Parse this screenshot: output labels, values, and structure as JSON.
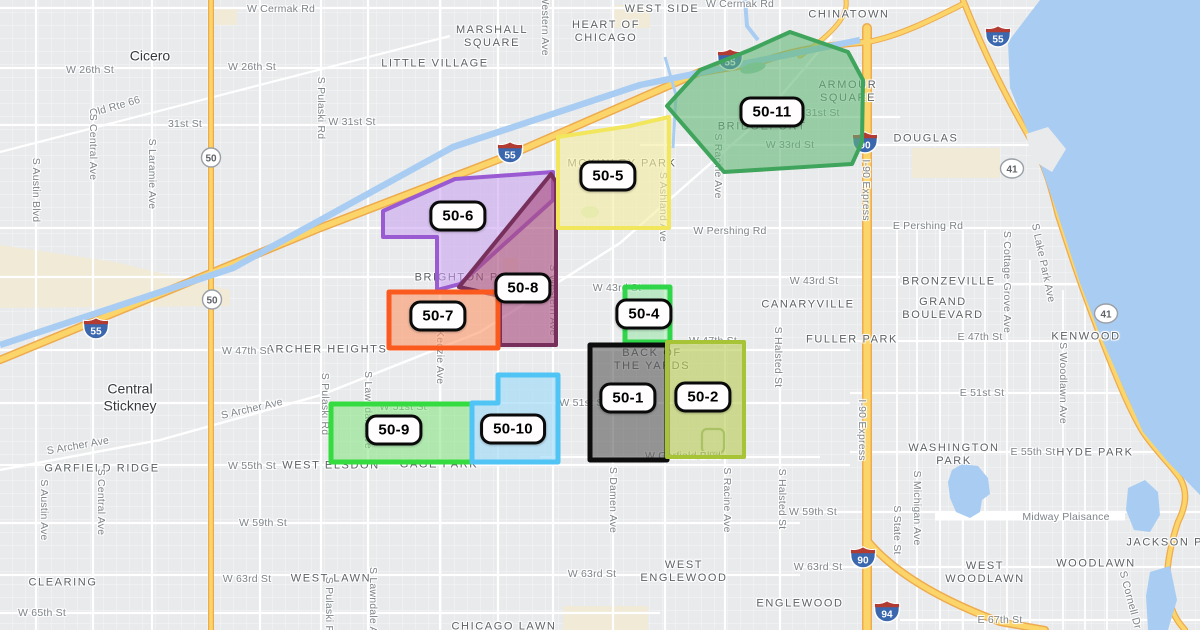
{
  "map": {
    "attribution": "",
    "colors": {
      "land": "#e9eaec",
      "water": "#a9cdf2",
      "road": "#ffffff",
      "highway_fill": "#fbd56a",
      "highway_casing": "#eeab4e",
      "park_beige": "#f0ead7",
      "hood_text": "#5d6266",
      "street_text": "#7e8489",
      "zone_label_bg": "#fffdfd",
      "zone_label_border": "#0a0a0a"
    },
    "zones": [
      {
        "id": "zone-50-6",
        "label": "50-6",
        "stroke": "#9a5bd2",
        "fill": "#c79df0",
        "fill_opacity": 0.55,
        "stroke_width": 4,
        "points": "383,211 455,179 553,172 553,200 460,284 437,290 437,237 383,237",
        "label_x": 458,
        "label_y": 216
      },
      {
        "id": "zone-50-8",
        "label": "50-8",
        "stroke": "#77305c",
        "fill": "#aa4e7e",
        "fill_opacity": 0.62,
        "stroke_width": 4,
        "points": "551,174 556,182 556,345 500,345 500,296 459,287",
        "label_x": 523,
        "label_y": 288
      },
      {
        "id": "zone-50-5",
        "label": "50-5",
        "stroke": "#f2e65c",
        "fill": "#f6eea0",
        "fill_opacity": 0.62,
        "stroke_width": 4,
        "points": "558,137 630,126 669,117 669,228 558,228",
        "label_x": 608,
        "label_y": 176
      },
      {
        "id": "zone-50-11",
        "label": "50-11",
        "stroke": "#3fa45c",
        "fill": "#63b877",
        "fill_opacity": 0.6,
        "stroke_width": 4,
        "points": "790,32 848,52 863,80 862,142 852,164 724,172 667,106 700,70 750,50",
        "label_x": 772,
        "label_y": 112
      },
      {
        "id": "zone-50-7",
        "label": "50-7",
        "stroke": "#fa5a1e",
        "fill": "#fb9a6c",
        "fill_opacity": 0.62,
        "stroke_width": 5,
        "points": "389,292 498,292 498,348 389,348",
        "label_x": 438,
        "label_y": 316
      },
      {
        "id": "zone-50-4",
        "label": "50-4",
        "stroke": "#2fd64a",
        "fill": "#8fe59f",
        "fill_opacity": 0.5,
        "stroke_width": 5,
        "points": "625,287 670,287 670,342 625,342",
        "label_x": 644,
        "label_y": 314
      },
      {
        "id": "zone-50-1",
        "label": "50-1",
        "stroke": "#0d0d0d",
        "fill": "#555555",
        "fill_opacity": 0.58,
        "stroke_width": 5,
        "points": "590,345 667,345 667,460 590,460",
        "label_x": 628,
        "label_y": 398
      },
      {
        "id": "zone-50-2",
        "label": "50-2",
        "stroke": "#a6c435",
        "fill": "#b9cc55",
        "fill_opacity": 0.62,
        "stroke_width": 4,
        "points": "667,342 744,342 744,457 667,457",
        "label_x": 703,
        "label_y": 397
      },
      {
        "id": "zone-50-9",
        "label": "50-9",
        "stroke": "#35dc3f",
        "fill": "#7fe47c",
        "fill_opacity": 0.55,
        "stroke_width": 5,
        "points": "331,404 472,404 472,462 331,462",
        "label_x": 394,
        "label_y": 430
      },
      {
        "id": "zone-50-10",
        "label": "50-10",
        "stroke": "#4fc4f5",
        "fill": "#a5dcf8",
        "fill_opacity": 0.7,
        "stroke_width": 5,
        "points": "498,375 558,375 558,462 472,462 472,403 498,403",
        "label_x": 513,
        "label_y": 429
      }
    ],
    "neighborhoods": [
      {
        "text": "Cicero",
        "x": 150,
        "y": 56,
        "style": "town"
      },
      {
        "text": "Central\nStickney",
        "x": 130,
        "y": 397,
        "style": "town"
      },
      {
        "text": "MARSHALL\nSQUARE",
        "x": 492,
        "y": 37,
        "style": "hood"
      },
      {
        "text": "LITTLE VILLAGE",
        "x": 435,
        "y": 64,
        "style": "hood"
      },
      {
        "text": "HEART OF\nCHICAGO",
        "x": 606,
        "y": 32,
        "style": "hood"
      },
      {
        "text": "LOWER\nWEST SIDE",
        "x": 662,
        "y": 3,
        "style": "hood"
      },
      {
        "text": "CHINATOWN",
        "x": 849,
        "y": 15,
        "style": "hood"
      },
      {
        "text": "ARMOUR\nSQUARE",
        "x": 848,
        "y": 92,
        "style": "hood"
      },
      {
        "text": "DOUGLAS",
        "x": 926,
        "y": 139,
        "style": "hood"
      },
      {
        "text": "BRIDGEPORT",
        "x": 762,
        "y": 127,
        "style": "hood"
      },
      {
        "text": "MCKINLEY PARK",
        "x": 622,
        "y": 164,
        "style": "hood"
      },
      {
        "text": "BRIGHTON PARK",
        "x": 470,
        "y": 278,
        "style": "hood"
      },
      {
        "text": "ARCHER HEIGHTS",
        "x": 327,
        "y": 350,
        "style": "hood"
      },
      {
        "text": "BACK OF\nTHE YARDS",
        "x": 652,
        "y": 360,
        "style": "hood"
      },
      {
        "text": "CANARYVILLE",
        "x": 808,
        "y": 305,
        "style": "hood"
      },
      {
        "text": "FULLER PARK",
        "x": 852,
        "y": 340,
        "style": "hood"
      },
      {
        "text": "BRONZEVILLE",
        "x": 949,
        "y": 282,
        "style": "hood"
      },
      {
        "text": "GRAND\nBOULEVARD",
        "x": 943,
        "y": 309,
        "style": "hood"
      },
      {
        "text": "KENWOOD",
        "x": 1086,
        "y": 337,
        "style": "hood"
      },
      {
        "text": "WASHINGTON\nPARK",
        "x": 954,
        "y": 455,
        "style": "hood"
      },
      {
        "text": "HYDE PARK",
        "x": 1095,
        "y": 453,
        "style": "hood"
      },
      {
        "text": "WEST ELSDON",
        "x": 331,
        "y": 466,
        "style": "hood"
      },
      {
        "text": "GAGE PARK",
        "x": 439,
        "y": 465,
        "style": "hood"
      },
      {
        "text": "GARFIELD RIDGE",
        "x": 102,
        "y": 469,
        "style": "hood"
      },
      {
        "text": "CLEARING",
        "x": 63,
        "y": 583,
        "style": "hood"
      },
      {
        "text": "WEST LAWN",
        "x": 331,
        "y": 579,
        "style": "hood"
      },
      {
        "text": "WEST\nENGLEWOOD",
        "x": 684,
        "y": 572,
        "style": "hood"
      },
      {
        "text": "ENGLEWOOD",
        "x": 800,
        "y": 604,
        "style": "hood"
      },
      {
        "text": "CHICAGO LAWN",
        "x": 504,
        "y": 627,
        "style": "hood"
      },
      {
        "text": "WEST\nWOODLAWN",
        "x": 985,
        "y": 573,
        "style": "hood"
      },
      {
        "text": "WOODLAWN",
        "x": 1096,
        "y": 564,
        "style": "hood"
      },
      {
        "text": "JACKSON PARK",
        "x": 1178,
        "y": 543,
        "style": "hood"
      }
    ],
    "streets": [
      {
        "text": "W Cermak Rd",
        "x": 281,
        "y": 9,
        "r": 0
      },
      {
        "text": "W Cermak Rd",
        "x": 740,
        "y": 4,
        "r": 0
      },
      {
        "text": "W 26th St",
        "x": 90,
        "y": 70,
        "r": 0
      },
      {
        "text": "W 26th St",
        "x": 252,
        "y": 67,
        "r": 0
      },
      {
        "text": "Old Rte 66",
        "x": 115,
        "y": 107,
        "r": -16
      },
      {
        "text": "31st St",
        "x": 185,
        "y": 124,
        "r": 0
      },
      {
        "text": "W 31st St",
        "x": 352,
        "y": 122,
        "r": 0
      },
      {
        "text": "W 31st St",
        "x": 816,
        "y": 113,
        "r": 0
      },
      {
        "text": "W 33rd St",
        "x": 790,
        "y": 145,
        "r": 0
      },
      {
        "text": "W Pershing Rd",
        "x": 730,
        "y": 231,
        "r": 0
      },
      {
        "text": "E Pershing Rd",
        "x": 928,
        "y": 226,
        "r": 0
      },
      {
        "text": "W 43rd St",
        "x": 617,
        "y": 288,
        "r": 0
      },
      {
        "text": "W 43rd St",
        "x": 814,
        "y": 281,
        "r": 0
      },
      {
        "text": "W 47th St",
        "x": 246,
        "y": 351,
        "r": 0
      },
      {
        "text": "W 47th St",
        "x": 713,
        "y": 341,
        "r": 0
      },
      {
        "text": "E 47th St",
        "x": 980,
        "y": 337,
        "r": 0
      },
      {
        "text": "W 51st St",
        "x": 403,
        "y": 407,
        "r": 0
      },
      {
        "text": "W 51st St",
        "x": 583,
        "y": 403,
        "r": 0
      },
      {
        "text": "E 51st St",
        "x": 982,
        "y": 393,
        "r": 0
      },
      {
        "text": "W 55th St",
        "x": 252,
        "y": 466,
        "r": 0
      },
      {
        "text": "E 55th St",
        "x": 1033,
        "y": 452,
        "r": 0
      },
      {
        "text": "W 59th St",
        "x": 263,
        "y": 523,
        "r": 0
      },
      {
        "text": "W 59th St",
        "x": 813,
        "y": 512,
        "r": 0
      },
      {
        "text": "W 63rd St",
        "x": 247,
        "y": 579,
        "r": 0
      },
      {
        "text": "W 63rd St",
        "x": 592,
        "y": 574,
        "r": 0
      },
      {
        "text": "W 63rd St",
        "x": 818,
        "y": 567,
        "r": 0
      },
      {
        "text": "W 65th St",
        "x": 42,
        "y": 613,
        "r": 0
      },
      {
        "text": "E 67th St",
        "x": 1000,
        "y": 620,
        "r": 0
      },
      {
        "text": "W Garfield Blvd",
        "x": 683,
        "y": 456,
        "r": 0
      },
      {
        "text": "S Archer Ave",
        "x": 252,
        "y": 409,
        "r": -13
      },
      {
        "text": "S Archer Ave",
        "x": 78,
        "y": 446,
        "r": -10
      },
      {
        "text": "Midway Plaisance",
        "x": 1066,
        "y": 517,
        "r": 0
      },
      {
        "text": "S Pulaski Rd",
        "x": 321,
        "y": 108,
        "r": 90
      },
      {
        "text": "S Central Ave",
        "x": 93,
        "y": 147,
        "r": 90
      },
      {
        "text": "S Laramie Ave",
        "x": 152,
        "y": 174,
        "r": 90
      },
      {
        "text": "S Austin Blvd",
        "x": 36,
        "y": 190,
        "r": 90
      },
      {
        "text": "S Western Ave",
        "x": 545,
        "y": 20,
        "r": 90
      },
      {
        "text": "S Western Ave",
        "x": 553,
        "y": 300,
        "r": 90
      },
      {
        "text": "S Kedzie Ave",
        "x": 440,
        "y": 352,
        "r": 90
      },
      {
        "text": "S Lawndale Ave",
        "x": 368,
        "y": 410,
        "r": 90
      },
      {
        "text": "S Pulaski Rd",
        "x": 325,
        "y": 404,
        "r": 90
      },
      {
        "text": "S Pulaski Rd",
        "x": 329,
        "y": 608,
        "r": 90
      },
      {
        "text": "S Lawndale Ave",
        "x": 373,
        "y": 606,
        "r": 90
      },
      {
        "text": "S Austin Ave",
        "x": 44,
        "y": 510,
        "r": 90
      },
      {
        "text": "S Central Ave",
        "x": 101,
        "y": 502,
        "r": 90
      },
      {
        "text": "S Damen Ave",
        "x": 613,
        "y": 500,
        "r": 90
      },
      {
        "text": "S Racine Ave",
        "x": 727,
        "y": 500,
        "r": 90
      },
      {
        "text": "S Racine Ave",
        "x": 718,
        "y": 166,
        "r": 90
      },
      {
        "text": "S Ashland Ave",
        "x": 663,
        "y": 207,
        "r": 90
      },
      {
        "text": "S Halsted St",
        "x": 778,
        "y": 357,
        "r": 90
      },
      {
        "text": "S Halsted St",
        "x": 782,
        "y": 499,
        "r": 90
      },
      {
        "text": "S State St",
        "x": 897,
        "y": 530,
        "r": 90
      },
      {
        "text": "S Michigan Ave",
        "x": 917,
        "y": 508,
        "r": 90
      },
      {
        "text": "S Cottage Grove Ave",
        "x": 1007,
        "y": 282,
        "r": 90
      },
      {
        "text": "S Lake Park Ave",
        "x": 1043,
        "y": 263,
        "r": 78
      },
      {
        "text": "S Woodlawn Ave",
        "x": 1063,
        "y": 383,
        "r": 90
      },
      {
        "text": "S Cornell Dr",
        "x": 1130,
        "y": 600,
        "r": 75
      },
      {
        "text": "I-90 Express",
        "x": 866,
        "y": 190,
        "r": 90
      },
      {
        "text": "I-90 Express",
        "x": 862,
        "y": 430,
        "r": 90
      }
    ],
    "shields": [
      {
        "type": "interstate",
        "num": "55",
        "x": 96,
        "y": 331
      },
      {
        "type": "interstate",
        "num": "55",
        "x": 510,
        "y": 155
      },
      {
        "type": "interstate",
        "num": "55",
        "x": 730,
        "y": 62
      },
      {
        "type": "interstate",
        "num": "55",
        "x": 998,
        "y": 39
      },
      {
        "type": "interstate",
        "num": "90",
        "x": 865,
        "y": 145
      },
      {
        "type": "interstate",
        "num": "90",
        "x": 863,
        "y": 560
      },
      {
        "type": "interstate",
        "num": "94",
        "x": 887,
        "y": 614
      },
      {
        "type": "us",
        "num": "41",
        "x": 1012,
        "y": 171
      },
      {
        "type": "us",
        "num": "41",
        "x": 1106,
        "y": 316
      },
      {
        "type": "state",
        "num": "50",
        "x": 211,
        "y": 160
      },
      {
        "type": "state",
        "num": "50",
        "x": 212,
        "y": 302
      }
    ]
  }
}
